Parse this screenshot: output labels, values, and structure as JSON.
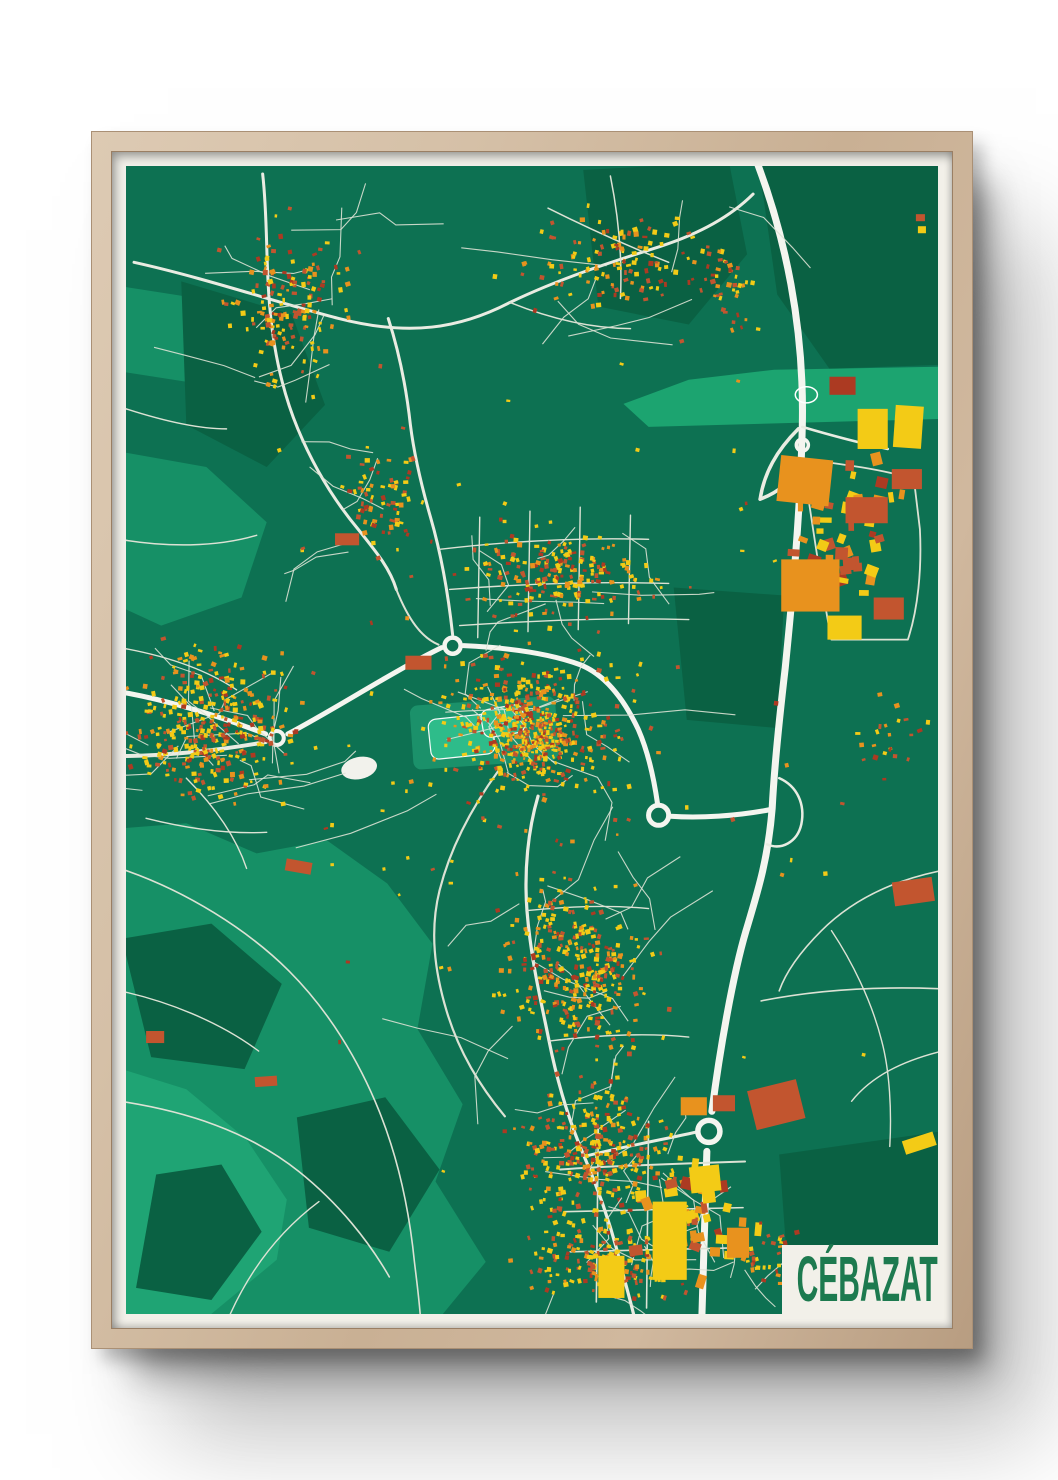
{
  "poster": {
    "title": "CÉBAZAT",
    "title_color": "#1D7A4F",
    "frame_color": "#CDB59B",
    "mat_color": "#F2F0E9"
  },
  "map": {
    "width": 808,
    "height": 1144,
    "seed": 20240613,
    "colors": {
      "base": "#0D7152",
      "light": "#169066",
      "lighter": "#1FA474",
      "dark": "#0A6143",
      "mint": "#1CA470",
      "park": "#2FBE8C",
      "road1": "#E9ECE2",
      "road2": "#F4F5EF",
      "road3": "#DCE2D4",
      "pond": "#F2F2EC",
      "buildings": {
        "yellow": "#F3CB16",
        "orange": "#E8921E",
        "red": "#C2552F",
        "darkred": "#AC3A22"
      }
    },
    "buildingWeights": [
      [
        0.42,
        "yellow"
      ],
      [
        0.22,
        "orange"
      ],
      [
        0.24,
        "red"
      ],
      [
        0.12,
        "darkred"
      ]
    ],
    "avoidRegions": [
      {
        "x1": 640,
        "y1": 0,
        "x2": 812,
        "y2": 196
      }
    ],
    "patches": [
      {
        "c": "light",
        "pts": "-4,660 60,655 130,685 200,672 260,715 305,775 290,860 335,935 308,1012 358,1092 312,1148 -4,1148"
      },
      {
        "c": "lighter",
        "pts": "-4,900 60,920 120,970 160,1030 150,1090 80,1148 -4,1148"
      },
      {
        "c": "light",
        "pts": "-4,285 80,300 140,355 115,430 35,458 -4,440"
      },
      {
        "c": "light",
        "pts": "-4,120 60,130 90,175 60,215 -4,205"
      },
      {
        "c": "dark",
        "pts": "628,-4 812,-4 812,198 700,202 648,128 635,36"
      },
      {
        "c": "dark",
        "pts": "455,4 600,-4 618,88 560,158 470,140"
      },
      {
        "c": "dark",
        "pts": "545,420 655,428 648,560 558,552"
      },
      {
        "c": "dark",
        "pts": "-4,770 85,755 155,815 118,900 25,888"
      },
      {
        "c": "dark",
        "pts": "170,948 258,928 312,1000 262,1082 182,1058"
      },
      {
        "c": "dark",
        "pts": "30,1005 95,995 135,1062 85,1130 10,1118"
      },
      {
        "c": "dark",
        "pts": "55,115 165,148 198,238 140,300 60,258"
      },
      {
        "c": "dark",
        "pts": "650,985 812,962 812,1148 662,1148"
      },
      {
        "c": "mint",
        "pts": "495,237 560,213 645,203 812,200 812,252 520,260"
      }
    ],
    "parks": [
      {
        "x": 282,
        "y": 538,
        "w": 145,
        "h": 64,
        "r": -4,
        "soft": true
      },
      {
        "x": 300,
        "y": 552,
        "w": 64,
        "h": 40,
        "r": -6
      },
      {
        "x": 352,
        "y": 543,
        "w": 42,
        "h": 28,
        "r": -10
      }
    ],
    "ponds": [
      {
        "x": 232,
        "y": 600,
        "rx": 18,
        "ry": 11,
        "rot": -12,
        "fill": true
      },
      {
        "x": 677,
        "y": 228,
        "rx": 11,
        "ry": 8,
        "rot": 0,
        "fill": false
      }
    ],
    "roads": [
      {
        "c": "road2",
        "w": 7,
        "d": "M627,-6 C656,70 675,160 673,258 C671,348 663,430 656,500 C649,560 645,600 643,640 C639,690 629,722 617,762 C604,806 591,880 583,942"
      },
      {
        "c": "road2",
        "w": 7,
        "d": "M578,982 L573,1148"
      },
      {
        "c": "road1",
        "w": 3.5,
        "d": "M669,262 C647,284 635,306 631,332"
      },
      {
        "c": "road1",
        "w": 3.5,
        "d": "M631,332 C647,326 661,316 669,300"
      },
      {
        "c": "road2",
        "w": 5,
        "d": "M643,641 C608,648 570,650 542,648"
      },
      {
        "c": "road1",
        "w": 2.5,
        "d": "M650,610 C668,618 676,636 672,656 C668,674 652,682 638,676"
      },
      {
        "c": "road2",
        "w": 5,
        "d": "M-6,524 C40,532 92,548 139,566"
      },
      {
        "c": "road1",
        "w": 4,
        "d": "M-6,588 C40,588 95,582 139,574"
      },
      {
        "c": "road2",
        "w": 5,
        "d": "M161,566 C210,540 265,504 314,480"
      },
      {
        "c": "road2",
        "w": 5,
        "d": "M336,478 C380,480 422,486 452,497 C477,507 496,532 510,562 C520,585 526,615 529,636"
      },
      {
        "c": "road1",
        "w": 3,
        "d": "M325,467 C321,430 314,388 303,350 C295,322 287,290 283,258 C279,222 272,186 261,152"
      },
      {
        "c": "road1",
        "w": 3,
        "d": "M8,96 C80,112 150,136 212,152 C282,170 332,162 382,136 C432,112 482,96 532,80 C572,67 602,50 624,28"
      },
      {
        "c": "road1",
        "w": 3,
        "d": "M136,8 C141,52 139,96 143,140 C147,186 156,226 171,262 C186,298 206,332 231,362 C251,387 263,402 269,422"
      },
      {
        "c": "road3",
        "w": 2,
        "d": "M269,422 C281,452 294,470 311,477"
      },
      {
        "c": "road1",
        "w": 3.2,
        "d": "M410,628 C400,662 396,702 399,742 C403,792 413,832 421,872 C429,912 441,952 456,987 C471,1022 481,1052 489,1082 C495,1107 501,1127 506,1148"
      },
      {
        "c": "road3",
        "w": 2.2,
        "d": "M371,602 C342,642 322,682 312,722 C302,762 307,802 319,842 C331,882 352,917 377,947"
      },
      {
        "c": "road1",
        "w": 3,
        "d": "M456,987 C496,977 540,969 566,963"
      },
      {
        "c": "road3",
        "w": 2,
        "d": "M432,1000 C490,996 550,994 616,992"
      },
      {
        "c": "road3",
        "w": 1.6,
        "d": "M436,1042 L614,1038"
      },
      {
        "c": "road3",
        "w": 1.6,
        "d": "M442,1082 L608,1078"
      },
      {
        "c": "road3",
        "w": 1.6,
        "d": "M470,958 L468,1132"
      },
      {
        "c": "road3",
        "w": 1.6,
        "d": "M520,952 L518,1138"
      },
      {
        "c": "road3",
        "w": 1.4,
        "d": "M312,382 C380,374 450,370 520,372"
      },
      {
        "c": "road3",
        "w": 1.4,
        "d": "M322,422 C400,416 470,414 540,416"
      },
      {
        "c": "road3",
        "w": 1.4,
        "d": "M332,458 C420,452 500,450 560,452"
      },
      {
        "c": "road3",
        "w": 1.4,
        "d": "M352,350 L350,470"
      },
      {
        "c": "road3",
        "w": 1.4,
        "d": "M402,344 L400,464"
      },
      {
        "c": "road3",
        "w": 1.4,
        "d": "M452,340 L450,462"
      },
      {
        "c": "road3",
        "w": 1.4,
        "d": "M502,348 L500,456"
      },
      {
        "c": "road3",
        "w": 1.5,
        "d": "M420,42 C460,62 500,80 540,96"
      },
      {
        "c": "road3",
        "w": 1.5,
        "d": "M482,10 C490,50 494,90 492,132"
      },
      {
        "c": "road3",
        "w": 1.5,
        "d": "M382,136 C422,152 462,162 502,162"
      },
      {
        "c": "road3",
        "w": 1.6,
        "d": "M-6,700 C60,722 122,762 162,802 C202,842 232,892 252,942 C272,992 282,1042 287,1092 C290,1117 292,1132 293,1148"
      },
      {
        "c": "road3",
        "w": 1.6,
        "d": "M-6,932 C60,942 122,962 172,1002 C212,1034 242,1072 262,1107"
      },
      {
        "c": "road3",
        "w": 1.4,
        "d": "M102,1148 C122,1102 152,1062 192,1032"
      },
      {
        "c": "road3",
        "w": 1.4,
        "d": "M-6,822 C40,832 92,852 132,882"
      },
      {
        "c": "road3",
        "w": 1.6,
        "d": "M632,832 C682,822 742,817 812,820"
      },
      {
        "c": "road3",
        "w": 1.6,
        "d": "M812,702 C762,712 722,732 692,762 C672,782 657,802 650,822"
      },
      {
        "c": "road3",
        "w": 1.4,
        "d": "M702,762 C722,792 742,832 752,872 C760,902 762,942 760,977"
      },
      {
        "c": "road3",
        "w": 1.4,
        "d": "M812,882 C772,892 742,907 722,932"
      },
      {
        "c": "road3",
        "w": 1.8,
        "d": "M673,292 C712,297 752,302 784,312 L790,362 C792,402 788,442 778,472 L702,472 C692,422 684,362 673,292"
      },
      {
        "c": "road1",
        "w": 2.6,
        "d": "M673,260 C700,268 730,276 758,282"
      },
      {
        "c": "road3",
        "w": 1.5,
        "d": "M-6,240 C30,252 70,262 100,262"
      },
      {
        "c": "road3",
        "w": 1.5,
        "d": "M-6,372 C40,380 90,380 130,368"
      },
      {
        "c": "road3",
        "w": 1.4,
        "d": "M399,742 C440,738 480,736 520,740"
      },
      {
        "c": "road3",
        "w": 1.4,
        "d": "M421,872 C470,866 520,864 560,868"
      },
      {
        "c": "road3",
        "w": 1.4,
        "d": "M-6,480 C40,488 80,502 110,522"
      },
      {
        "c": "road3",
        "w": 1.4,
        "d": "M60,610 C90,640 110,670 120,700"
      },
      {
        "c": "road3",
        "w": 1.4,
        "d": "M20,650 C60,660 100,666 140,664"
      }
    ],
    "roundabouts": [
      {
        "x": 150,
        "y": 570,
        "r": 7,
        "w": 4
      },
      {
        "x": 325,
        "y": 478,
        "r": 8,
        "w": 4.5
      },
      {
        "x": 530,
        "y": 647,
        "r": 10,
        "w": 5
      },
      {
        "x": 580,
        "y": 962,
        "r": 11,
        "w": 5.5
      },
      {
        "x": 673,
        "y": 278,
        "r": 6,
        "w": 3.5
      }
    ],
    "clusters": [
      {
        "cx": 160,
        "cy": 140,
        "rx": 80,
        "ry": 115,
        "n": 150,
        "streets": 10
      },
      {
        "cx": 255,
        "cy": 330,
        "rx": 55,
        "ry": 75,
        "n": 70,
        "streets": 5
      },
      {
        "cx": 490,
        "cy": 95,
        "rx": 140,
        "ry": 72,
        "n": 120,
        "streets": 6,
        "avoid": 1
      },
      {
        "cx": 600,
        "cy": 120,
        "rx": 45,
        "ry": 60,
        "n": 40,
        "avoid": 1
      },
      {
        "cx": 85,
        "cy": 560,
        "rx": 112,
        "ry": 108,
        "n": 330,
        "streets": 16
      },
      {
        "cx": 408,
        "cy": 560,
        "rx": 128,
        "ry": 92,
        "n": 380,
        "streets": 14
      },
      {
        "cx": 402,
        "cy": 572,
        "rx": 56,
        "ry": 46,
        "n": 170,
        "s": [
          2,
          4.4
        ]
      },
      {
        "cx": 430,
        "cy": 408,
        "rx": 120,
        "ry": 58,
        "n": 190,
        "streets": 8
      },
      {
        "cx": 448,
        "cy": 800,
        "rx": 100,
        "ry": 112,
        "n": 300,
        "streets": 14
      },
      {
        "cx": 468,
        "cy": 978,
        "rx": 110,
        "ry": 98,
        "n": 280,
        "streets": 12
      },
      {
        "cx": 480,
        "cy": 1092,
        "rx": 112,
        "ry": 52,
        "n": 170,
        "streets": 6
      },
      {
        "cx": 405,
        "cy": 571,
        "rx": 400,
        "ry": 565,
        "n": 120,
        "avoid": 1,
        "s": [
          2.2,
          4.6
        ]
      },
      {
        "cx": 722,
        "cy": 360,
        "rx": 82,
        "ry": 105,
        "n": 40,
        "s": [
          5,
          13
        ]
      },
      {
        "cx": 560,
        "cy": 1050,
        "rx": 88,
        "ry": 92,
        "n": 34,
        "s": [
          5,
          14
        ]
      },
      {
        "cx": 758,
        "cy": 572,
        "rx": 48,
        "ry": 52,
        "n": 22
      },
      {
        "cx": 640,
        "cy": 1090,
        "rx": 55,
        "ry": 48,
        "n": 36,
        "streets": 4
      }
    ],
    "bigBuildings": [
      {
        "x": 652,
        "y": 288,
        "w": 52,
        "h": 46,
        "c": "orange",
        "r": 6
      },
      {
        "x": 652,
        "y": 392,
        "w": 58,
        "h": 52,
        "c": "orange",
        "r": 0
      },
      {
        "x": 728,
        "y": 242,
        "w": 30,
        "h": 40,
        "c": "yellow",
        "r": 0
      },
      {
        "x": 766,
        "y": 238,
        "w": 28,
        "h": 42,
        "c": "yellow",
        "r": 4
      },
      {
        "x": 716,
        "y": 330,
        "w": 42,
        "h": 26,
        "c": "red",
        "r": 0
      },
      {
        "x": 762,
        "y": 302,
        "w": 30,
        "h": 20,
        "c": "red",
        "r": 0
      },
      {
        "x": 700,
        "y": 210,
        "w": 26,
        "h": 18,
        "c": "darkred",
        "r": 0
      },
      {
        "x": 744,
        "y": 430,
        "w": 30,
        "h": 22,
        "c": "red",
        "r": 0
      },
      {
        "x": 698,
        "y": 448,
        "w": 34,
        "h": 24,
        "c": "yellow",
        "r": 0
      },
      {
        "x": 786,
        "y": 48,
        "w": 9,
        "h": 7,
        "c": "red",
        "r": 0
      },
      {
        "x": 788,
        "y": 60,
        "w": 8,
        "h": 7,
        "c": "yellow",
        "r": 0
      },
      {
        "x": 618,
        "y": 922,
        "w": 50,
        "h": 40,
        "c": "red",
        "r": -14
      },
      {
        "x": 524,
        "y": 1032,
        "w": 34,
        "h": 78,
        "c": "yellow",
        "r": 0
      },
      {
        "x": 560,
        "y": 998,
        "w": 30,
        "h": 26,
        "c": "yellow",
        "r": -6
      },
      {
        "x": 470,
        "y": 1086,
        "w": 26,
        "h": 42,
        "c": "yellow",
        "r": 0
      },
      {
        "x": 598,
        "y": 1058,
        "w": 22,
        "h": 30,
        "c": "orange",
        "r": 0
      },
      {
        "x": 552,
        "y": 928,
        "w": 26,
        "h": 18,
        "c": "orange",
        "r": 0
      },
      {
        "x": 584,
        "y": 926,
        "w": 22,
        "h": 16,
        "c": "red",
        "r": 0
      },
      {
        "x": 762,
        "y": 714,
        "w": 40,
        "h": 24,
        "c": "red",
        "r": -8
      },
      {
        "x": 772,
        "y": 972,
        "w": 32,
        "h": 14,
        "c": "yellow",
        "r": -18
      },
      {
        "x": 278,
        "y": 488,
        "w": 26,
        "h": 14,
        "c": "red",
        "r": 0
      },
      {
        "x": 208,
        "y": 366,
        "w": 24,
        "h": 12,
        "c": "red",
        "r": 0
      },
      {
        "x": 160,
        "y": 690,
        "w": 26,
        "h": 12,
        "c": "red",
        "r": 10
      },
      {
        "x": 20,
        "y": 862,
        "w": 18,
        "h": 12,
        "c": "red",
        "r": 0
      },
      {
        "x": 128,
        "y": 908,
        "w": 22,
        "h": 10,
        "c": "red",
        "r": -4
      }
    ]
  }
}
